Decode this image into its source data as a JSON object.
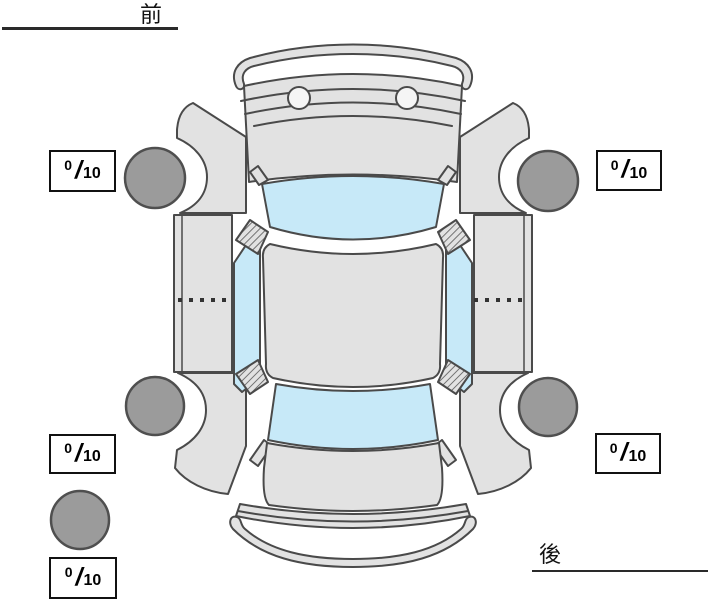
{
  "labels": {
    "front": "前",
    "rear": "後"
  },
  "separator": "/",
  "scores": {
    "front_left": {
      "value": "0",
      "max": "10"
    },
    "front_right": {
      "value": "0",
      "max": "10"
    },
    "rear_left": {
      "value": "0",
      "max": "10"
    },
    "rear_right": {
      "value": "0",
      "max": "10"
    },
    "spare": {
      "value": "0",
      "max": "10"
    }
  },
  "diagram": {
    "type": "car-top-view-tire-tread-diagram",
    "tires": [
      "front-left",
      "front-right",
      "rear-left",
      "rear-right",
      "spare"
    ],
    "colors": {
      "body": "#e2e2e2",
      "outline": "#4a4a4a",
      "glass": "#c7e9f8",
      "tire": "#9b9b9b",
      "tire_outline": "#4f4f4f",
      "box_border": "#111111"
    }
  }
}
